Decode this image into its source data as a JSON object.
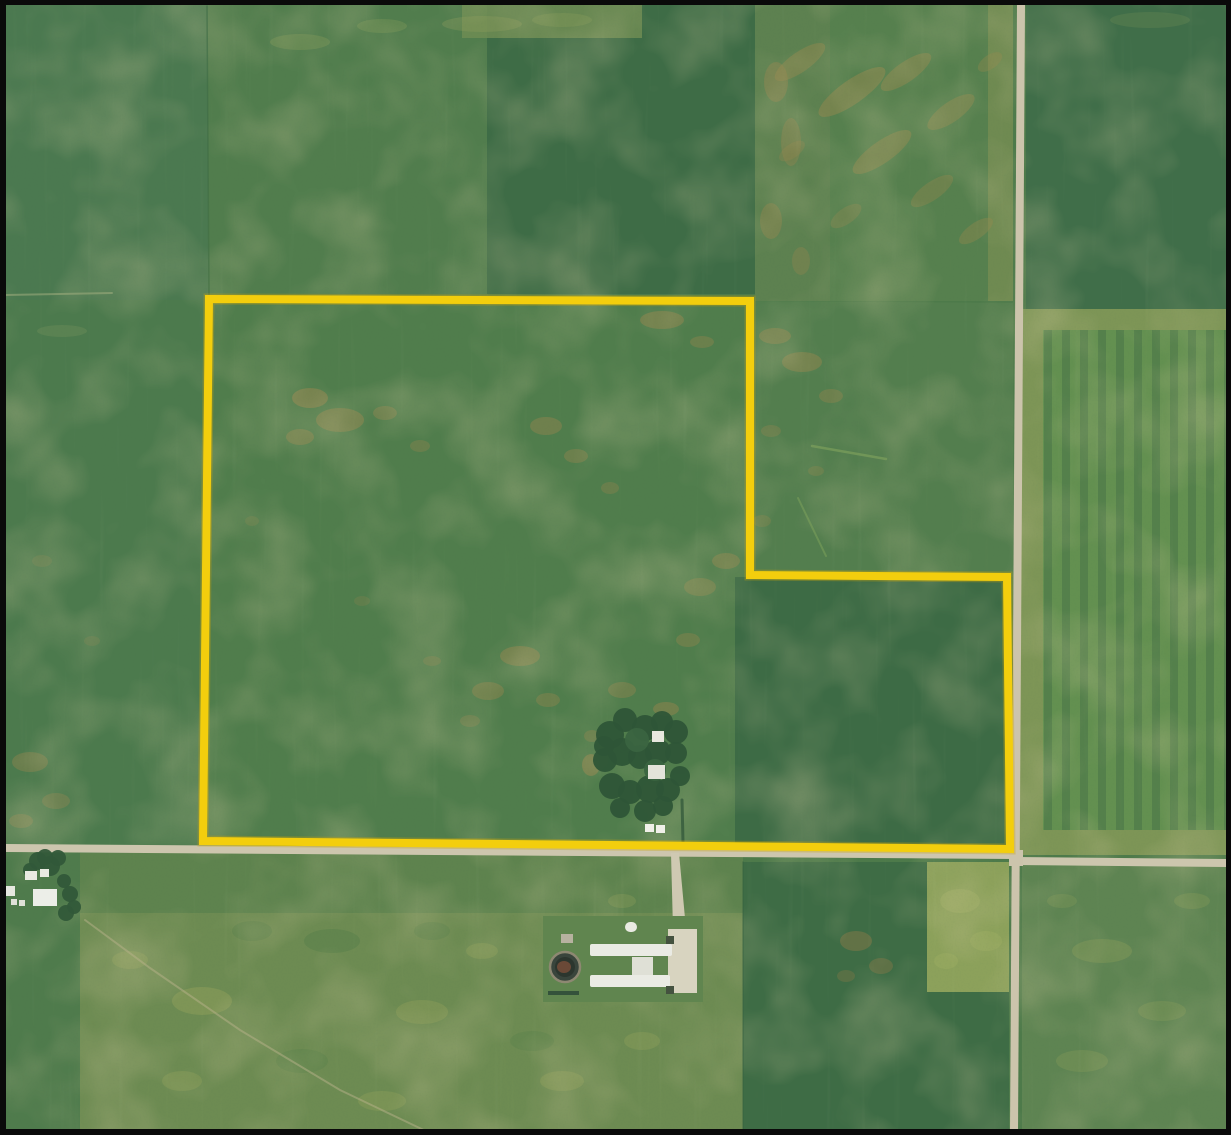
{
  "scene": {
    "width": 1231,
    "height": 1135,
    "base_fill": "#4d7a4a",
    "frame": {
      "color": "#0a0a0a",
      "top": 5,
      "left": 6,
      "right": 5,
      "bottom": 6
    },
    "boundary": {
      "name": "property-boundary",
      "points": "209,299 750,301 750,575 1007,577 1010,849 203,841",
      "stroke": "#F3CE0D",
      "width": 8,
      "under_stroke": "#C8A30C",
      "under_width": 11,
      "under_opacity": 0.35
    },
    "fields": [
      {
        "name": "field-upper-left",
        "rect": [
          5,
          4,
          203,
          296
        ],
        "fill": "#4b7950"
      },
      {
        "name": "field-upper-midleft",
        "rect": [
          208,
          4,
          280,
          297
        ],
        "fill": "#517d4d"
      },
      {
        "name": "field-upper-dark",
        "rect": [
          487,
          4,
          268,
          290
        ],
        "fill": "#3e6c46"
      },
      {
        "name": "field-upper-dark-topband",
        "rect": [
          462,
          4,
          180,
          34
        ],
        "fill": "#6f8c54",
        "opacity": 0.85
      },
      {
        "name": "field-band-east-of-dark",
        "rect": [
          755,
          4,
          75,
          297
        ],
        "fill": "#5d8150"
      },
      {
        "name": "field-upper-right",
        "rect": [
          830,
          4,
          182,
          297
        ],
        "fill": "#56804e"
      },
      {
        "name": "strip-west-of-road-north",
        "rect": [
          988,
          4,
          25,
          297
        ],
        "fill": "#6f8a51"
      },
      {
        "name": "field-ne-dark",
        "rect": [
          1026,
          4,
          201,
          305
        ],
        "fill": "#406e49"
      },
      {
        "name": "field-east-margin",
        "rect": [
          1019,
          309,
          208,
          546
        ],
        "fill": "#7d9556"
      },
      {
        "name": "field-east-striped",
        "rect": [
          1043,
          330,
          184,
          500
        ],
        "fill": "#639050"
      },
      {
        "name": "field-left-mid",
        "rect": [
          5,
          300,
          204,
          549
        ],
        "fill": "#4c7a4d"
      },
      {
        "name": "parcel-interior",
        "points": "209,299 750,301 750,575 1007,577 1010,849 203,841",
        "fill": "#507d4c"
      },
      {
        "name": "parcel-interior-dark",
        "points": "735,577 1004,578 1007,846 735,844",
        "fill": "#3d6b45"
      },
      {
        "name": "field-notch",
        "points": "750,301 1013,303 1013,577 750,575",
        "fill": "#537e4e"
      },
      {
        "name": "field-below-left",
        "rect": [
          5,
          853,
          75,
          277
        ],
        "fill": "#4f7b4c"
      },
      {
        "name": "field-below-center",
        "rect": [
          80,
          853,
          663,
          277
        ],
        "fill": "#6d8b52"
      },
      {
        "name": "field-below-center-top",
        "rect": [
          80,
          853,
          663,
          60
        ],
        "fill": "#5a814e",
        "opacity": 0.8
      },
      {
        "name": "field-below-right-dark",
        "points": "743,862 927,862 927,992 1009,992 1009,1130 743,1130",
        "fill": "#3e6c45"
      },
      {
        "name": "patch-below-bright",
        "rect": [
          927,
          862,
          82,
          130
        ],
        "fill": "#8ca15b"
      },
      {
        "name": "field-below-east",
        "rect": [
          1022,
          865,
          205,
          265
        ],
        "fill": "#5e8452"
      }
    ],
    "stripes": {
      "name": "crop-strips-east",
      "x": 1043,
      "y": 330,
      "w": 184,
      "h": 500,
      "period": 18,
      "stripe_width": 8,
      "dark": "#4f7a49",
      "opacity": 0.75
    },
    "noise": [
      {
        "name": "mottle-overlay",
        "freq": "0.013",
        "octaves": 3,
        "seed": 5,
        "rgb": "0.63 0.58 0.33",
        "alpha_scale": 1.5,
        "alpha_offset": -0.62,
        "opacity": 0.4
      },
      {
        "name": "grain-overlay",
        "freq": "0.6",
        "octaves": 2,
        "seed": 9,
        "rgb": "0.08 0.16 0.10",
        "alpha_scale": 0.9,
        "alpha_offset": -0.45,
        "opacity": 0.16
      },
      {
        "name": "rows-overlay",
        "freq": "0.16 0.006",
        "octaves": 2,
        "seed": 3,
        "rgb": "0.78 0.82 0.55",
        "alpha_scale": 1.1,
        "alpha_offset": -0.7,
        "opacity": 0.1
      }
    ],
    "patches": [
      [
        310,
        398,
        18,
        10,
        0.5
      ],
      [
        340,
        420,
        24,
        12,
        0.45
      ],
      [
        300,
        437,
        14,
        8,
        0.4
      ],
      [
        385,
        413,
        12,
        7,
        0.38
      ],
      [
        420,
        446,
        10,
        6,
        0.32
      ],
      [
        546,
        426,
        16,
        9,
        0.42
      ],
      [
        576,
        456,
        12,
        7,
        0.38
      ],
      [
        610,
        488,
        9,
        6,
        0.32
      ],
      [
        662,
        320,
        22,
        9,
        0.45
      ],
      [
        702,
        342,
        12,
        6,
        0.36
      ],
      [
        726,
        561,
        14,
        8,
        0.4
      ],
      [
        700,
        587,
        16,
        9,
        0.36
      ],
      [
        688,
        640,
        12,
        7,
        0.36
      ],
      [
        520,
        656,
        20,
        10,
        0.45
      ],
      [
        488,
        691,
        16,
        9,
        0.4
      ],
      [
        548,
        700,
        12,
        7,
        0.36
      ],
      [
        470,
        721,
        10,
        6,
        0.3
      ],
      [
        432,
        661,
        9,
        5,
        0.26
      ],
      [
        362,
        601,
        8,
        5,
        0.22
      ],
      [
        252,
        521,
        7,
        5,
        0.2
      ],
      [
        622,
        690,
        14,
        8,
        0.38
      ],
      [
        592,
        736,
        8,
        6,
        0.32
      ],
      [
        591,
        765,
        9,
        11,
        0.5
      ],
      [
        666,
        709,
        13,
        7,
        0.45
      ],
      [
        775,
        336,
        16,
        8,
        0.42
      ],
      [
        802,
        362,
        20,
        10,
        0.45
      ],
      [
        831,
        396,
        12,
        7,
        0.36
      ],
      [
        771,
        431,
        10,
        6,
        0.3
      ],
      [
        816,
        471,
        8,
        5,
        0.27
      ],
      [
        762,
        521,
        9,
        6,
        0.27
      ],
      [
        776,
        82,
        12,
        20,
        0.4
      ],
      [
        791,
        142,
        10,
        24,
        0.35
      ],
      [
        771,
        221,
        11,
        18,
        0.38
      ],
      [
        801,
        261,
        9,
        14,
        0.3
      ],
      [
        800,
        62,
        30,
        10,
        0.45,
        "#94874d",
        -35
      ],
      [
        852,
        92,
        40,
        12,
        0.5,
        "#94874d",
        -35
      ],
      [
        906,
        72,
        30,
        10,
        0.45,
        "#94874d",
        -35
      ],
      [
        951,
        112,
        28,
        10,
        0.42,
        "#94874d",
        -35
      ],
      [
        882,
        152,
        35,
        11,
        0.45,
        "#94874d",
        -35
      ],
      [
        932,
        191,
        25,
        9,
        0.38,
        "#94874d",
        -35
      ],
      [
        976,
        231,
        20,
        8,
        0.4,
        "#94874d",
        -35
      ],
      [
        846,
        216,
        18,
        8,
        0.32,
        "#94874d",
        -35
      ],
      [
        792,
        151,
        15,
        7,
        0.32,
        "#94874d",
        -35
      ],
      [
        990,
        62,
        14,
        7,
        0.36,
        "#94874d",
        -35
      ],
      [
        300,
        42,
        30,
        8,
        0.3,
        "#8fa05c"
      ],
      [
        382,
        26,
        25,
        7,
        0.28,
        "#8fa05c"
      ],
      [
        482,
        24,
        40,
        8,
        0.32,
        "#8fa05c"
      ],
      [
        562,
        20,
        30,
        7,
        0.28,
        "#8fa05c"
      ],
      [
        1150,
        20,
        40,
        8,
        0.18,
        "#8fa05c"
      ],
      [
        30,
        762,
        18,
        10,
        0.38
      ],
      [
        56,
        801,
        14,
        8,
        0.33
      ],
      [
        21,
        821,
        12,
        7,
        0.33
      ],
      [
        92,
        641,
        8,
        5,
        0.2
      ],
      [
        42,
        561,
        10,
        6,
        0.2
      ],
      [
        62,
        331,
        25,
        6,
        0.22,
        "#8fa065"
      ],
      [
        202,
        1001,
        30,
        14,
        0.4,
        "#99a45c"
      ],
      [
        422,
        1012,
        26,
        12,
        0.34,
        "#99a45c"
      ],
      [
        562,
        1081,
        22,
        10,
        0.34,
        "#99a45c"
      ],
      [
        642,
        1041,
        18,
        9,
        0.3,
        "#99a45c"
      ],
      [
        382,
        1101,
        24,
        10,
        0.3,
        "#99a45c"
      ],
      [
        182,
        1081,
        20,
        10,
        0.3,
        "#99a45c"
      ],
      [
        482,
        951,
        16,
        8,
        0.3,
        "#99a45c"
      ],
      [
        622,
        901,
        14,
        7,
        0.28,
        "#99a45c"
      ],
      [
        130,
        960,
        18,
        9,
        0.3,
        "#99a45c"
      ],
      [
        332,
        941,
        28,
        12,
        0.35,
        "#4e7a49"
      ],
      [
        252,
        931,
        20,
        10,
        0.3,
        "#4e7a49"
      ],
      [
        432,
        931,
        18,
        9,
        0.28,
        "#4e7a49"
      ],
      [
        532,
        1041,
        22,
        10,
        0.25,
        "#4e7a49"
      ],
      [
        302,
        1061,
        26,
        12,
        0.25,
        "#4e7a49"
      ],
      [
        856,
        941,
        16,
        10,
        0.45,
        "#8f7a48"
      ],
      [
        881,
        966,
        12,
        8,
        0.4,
        "#8f7a48"
      ],
      [
        846,
        976,
        9,
        6,
        0.32,
        "#8f7a48"
      ],
      [
        960,
        901,
        20,
        12,
        0.45,
        "#a0b065"
      ],
      [
        986,
        941,
        16,
        10,
        0.38,
        "#a0b065"
      ],
      [
        946,
        961,
        12,
        8,
        0.33,
        "#a0b065"
      ],
      [
        1102,
        951,
        30,
        12,
        0.32,
        "#92a25b"
      ],
      [
        1162,
        1011,
        24,
        10,
        0.28,
        "#92a25b"
      ],
      [
        1082,
        1061,
        26,
        11,
        0.28,
        "#92a25b"
      ],
      [
        1192,
        901,
        18,
        8,
        0.28,
        "#92a25b"
      ],
      [
        1062,
        901,
        15,
        7,
        0.24,
        "#92a25b"
      ]
    ],
    "tracks": [
      {
        "name": "track-below-left",
        "points": "85,920 150,968 240,1030 340,1090 430,1133",
        "stroke": "#b7b289",
        "w": 2,
        "o": 0.5
      },
      {
        "name": "track-notch-a",
        "points": "812,446 886,459",
        "stroke": "#86a85e",
        "w": 2.5,
        "o": 0.55
      },
      {
        "name": "track-notch-b",
        "points": "798,498 826,556",
        "stroke": "#86a85e",
        "w": 2,
        "o": 0.45
      },
      {
        "name": "fieldline-upper-left",
        "points": "207,6 209,297",
        "stroke": "#3f6c44",
        "w": 1.5,
        "o": 0.6
      },
      {
        "name": "fieldline-left",
        "points": "6,295 112,293",
        "stroke": "#a8b282",
        "w": 2,
        "o": 0.5
      },
      {
        "name": "fieldline-below-center",
        "points": "743,862 743,1130",
        "stroke": "#35603f",
        "w": 1.5,
        "o": 0.5
      },
      {
        "name": "grove-lane",
        "points": "682,800 683,842",
        "stroke": "#355a3c",
        "w": 3,
        "o": 0.8
      }
    ],
    "roads": [
      {
        "name": "road-horizontal-west",
        "points": "6,844 1014,851 1014,859 6,852",
        "fill": "#cdc6ae"
      },
      {
        "name": "road-horizontal-east",
        "points": "1014,857 1226,859 1226,867 1014,865",
        "fill": "#cdc6ae"
      },
      {
        "name": "road-vertical",
        "points": "1017,5 1025,5 1018,1130 1010,1130",
        "fill": "#ccc4ac"
      },
      {
        "name": "road-intersection",
        "points": "1009,850 1023,850 1023,866 1009,866",
        "fill": "#ccc4ac"
      },
      {
        "name": "facility-driveway",
        "points": "671,853 679,853 686,929 673,929",
        "fill": "#cfc9b2"
      }
    ],
    "buildings": [
      {
        "name": "facility-ground",
        "rect": [
          543,
          916,
          160,
          86
        ],
        "fill": "#60854f"
      },
      {
        "name": "facility-pad",
        "rect": [
          668,
          929,
          29,
          64
        ],
        "fill": "#d8d4c0"
      },
      {
        "name": "barn-north",
        "rect": [
          590,
          944,
          82,
          12
        ],
        "fill": "#eaebe4",
        "rx": 2
      },
      {
        "name": "barn-south",
        "rect": [
          590,
          975,
          80,
          12
        ],
        "fill": "#eaebe4",
        "rx": 2
      },
      {
        "name": "barn-connector",
        "rect": [
          632,
          957,
          21,
          18
        ],
        "fill": "#dfe0d6"
      },
      {
        "name": "feed-dome",
        "rect": [
          625,
          922,
          12,
          10
        ],
        "fill": "#e9eae2",
        "rx": 5
      },
      {
        "name": "equip-shed",
        "rect": [
          561,
          934,
          12,
          9
        ],
        "fill": "#b7b2a0"
      },
      {
        "name": "bin-north",
        "rect": [
          666,
          936,
          8,
          8
        ],
        "fill": "#44523f"
      },
      {
        "name": "bin-south",
        "rect": [
          666,
          986,
          8,
          8
        ],
        "fill": "#44523f"
      },
      {
        "name": "windbreak-hedge",
        "rect": [
          548,
          991,
          31,
          4
        ],
        "fill": "#34523b"
      },
      {
        "name": "grove-roof-north",
        "rect": [
          652,
          731,
          12,
          11
        ],
        "fill": "#e8e8df"
      },
      {
        "name": "grove-roof-south",
        "rect": [
          648,
          765,
          17,
          14
        ],
        "fill": "#e4e4da"
      },
      {
        "name": "vehicle-a",
        "rect": [
          645,
          824,
          9,
          8
        ],
        "fill": "#f0f0e9"
      },
      {
        "name": "vehicle-b",
        "rect": [
          656,
          825,
          9,
          8
        ],
        "fill": "#f0f0e9"
      },
      {
        "name": "farmstead-shed-a",
        "rect": [
          25,
          871,
          12,
          9
        ],
        "fill": "#e9eae2"
      },
      {
        "name": "farmstead-shed-b",
        "rect": [
          40,
          869,
          9,
          8
        ],
        "fill": "#e9eae2"
      },
      {
        "name": "farmstead-barn",
        "rect": [
          33,
          889,
          24,
          17
        ],
        "fill": "#eceee8"
      },
      {
        "name": "farmstead-bldg-west",
        "rect": [
          6,
          886,
          9,
          10
        ],
        "fill": "#e6e8e0"
      },
      {
        "name": "farmstead-dot-a",
        "rect": [
          11,
          899,
          6,
          6
        ],
        "fill": "#dfe1d8"
      },
      {
        "name": "farmstead-dot-b",
        "rect": [
          19,
          900,
          6,
          6
        ],
        "fill": "#dfe1d8"
      }
    ],
    "lagoon": {
      "name": "manure-lagoon",
      "cx": 565,
      "cy": 967,
      "r": 15,
      "fill": "#39453c",
      "inner": "#2c362e",
      "ring": "#8d8872",
      "spot": "#7a4f3a"
    },
    "tree_groups": [
      {
        "name": "tree-grove-parcel",
        "fill": "#2e5537",
        "trees": [
          [
            610,
            735,
            14
          ],
          [
            625,
            720,
            12
          ],
          [
            645,
            728,
            13
          ],
          [
            662,
            722,
            11
          ],
          [
            676,
            732,
            12
          ],
          [
            605,
            760,
            12
          ],
          [
            622,
            752,
            14
          ],
          [
            640,
            757,
            12
          ],
          [
            658,
            752,
            13
          ],
          [
            676,
            753,
            11
          ],
          [
            612,
            786,
            13
          ],
          [
            630,
            792,
            12
          ],
          [
            650,
            789,
            14
          ],
          [
            668,
            790,
            12
          ],
          [
            680,
            776,
            10
          ],
          [
            620,
            808,
            10
          ],
          [
            645,
            811,
            11
          ],
          [
            663,
            806,
            10
          ],
          [
            604,
            746,
            10
          ],
          [
            637,
            740,
            12,
            "#3a6440"
          ],
          [
            655,
            770,
            11,
            "#3a6440"
          ]
        ]
      },
      {
        "name": "trees-farmstead",
        "fill": "#315839",
        "trees": [
          [
            38,
            861,
            9
          ],
          [
            50,
            866,
            10
          ],
          [
            58,
            858,
            8
          ],
          [
            30,
            870,
            7
          ],
          [
            64,
            881,
            7
          ],
          [
            70,
            894,
            8
          ],
          [
            74,
            907,
            7
          ],
          [
            66,
            913,
            8
          ],
          [
            45,
            857,
            8
          ]
        ]
      }
    ]
  }
}
